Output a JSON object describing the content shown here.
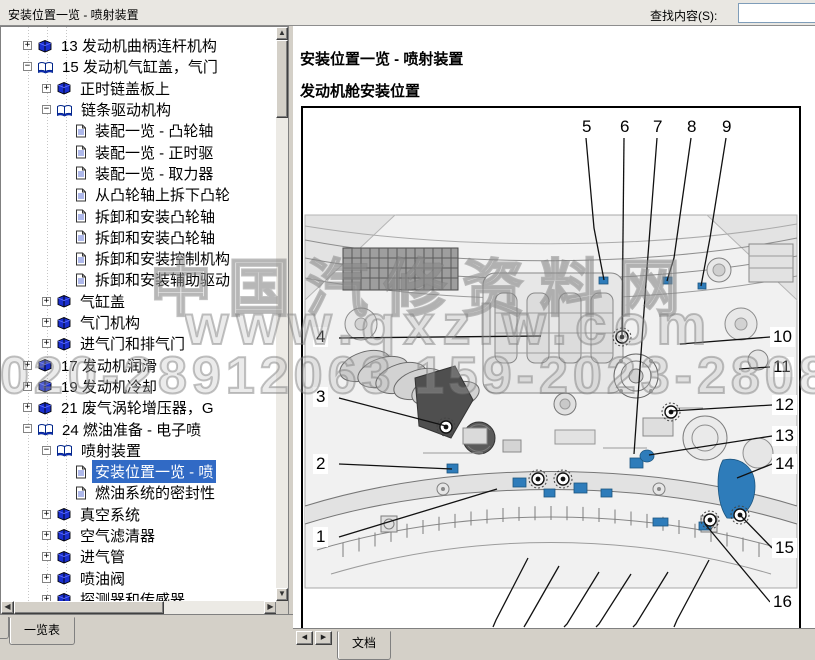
{
  "window": {
    "title": "安装位置一览 - 喷射装置",
    "find_label": "查找内容(S):",
    "find_value": ""
  },
  "sidebar": {
    "tab_label": "一览表",
    "items": [
      {
        "label": "13 发动机曲柄连杆机构",
        "level": 1,
        "icon": "book-closed",
        "expand": "plus"
      },
      {
        "label": "15 发动机气缸盖，气门",
        "level": 1,
        "icon": "book-open",
        "expand": "minus"
      },
      {
        "label": "正时链盖板上",
        "level": 2,
        "icon": "book-closed",
        "expand": "plus"
      },
      {
        "label": "链条驱动机构",
        "level": 2,
        "icon": "book-open",
        "expand": "minus"
      },
      {
        "label": "装配一览 - 凸轮轴",
        "level": 3,
        "icon": "page",
        "expand": "none"
      },
      {
        "label": "装配一览 - 正时驱",
        "level": 3,
        "icon": "page",
        "expand": "none"
      },
      {
        "label": "装配一览 - 取力器",
        "level": 3,
        "icon": "page",
        "expand": "none"
      },
      {
        "label": "从凸轮轴上拆下凸轮",
        "level": 3,
        "icon": "page",
        "expand": "none"
      },
      {
        "label": "拆卸和安装凸轮轴",
        "level": 3,
        "icon": "page",
        "expand": "none"
      },
      {
        "label": "拆卸和安装凸轮轴",
        "level": 3,
        "icon": "page",
        "expand": "none"
      },
      {
        "label": "拆卸和安装控制机构",
        "level": 3,
        "icon": "page",
        "expand": "none"
      },
      {
        "label": "拆卸和安装辅助驱动",
        "level": 3,
        "icon": "page",
        "expand": "none"
      },
      {
        "label": "气缸盖",
        "level": 2,
        "icon": "book-closed",
        "expand": "plus"
      },
      {
        "label": "气门机构",
        "level": 2,
        "icon": "book-closed",
        "expand": "plus"
      },
      {
        "label": "进气门和排气门",
        "level": 2,
        "icon": "book-closed",
        "expand": "plus"
      },
      {
        "label": "17 发动机润滑",
        "level": 1,
        "icon": "book-closed",
        "expand": "plus"
      },
      {
        "label": "19 发动机冷却",
        "level": 1,
        "icon": "book-closed",
        "expand": "plus"
      },
      {
        "label": "21 废气涡轮增压器，G",
        "level": 1,
        "icon": "book-closed",
        "expand": "plus"
      },
      {
        "label": "24 燃油准备 - 电子喷",
        "level": 1,
        "icon": "book-open",
        "expand": "minus"
      },
      {
        "label": "喷射装置",
        "level": 2,
        "icon": "book-open",
        "expand": "minus"
      },
      {
        "label": "安装位置一览 - 喷",
        "level": 3,
        "icon": "page",
        "expand": "none",
        "selected": true
      },
      {
        "label": "燃油系统的密封性",
        "level": 3,
        "icon": "page",
        "expand": "none"
      },
      {
        "label": "真空系统",
        "level": 2,
        "icon": "book-closed",
        "expand": "plus"
      },
      {
        "label": "空气滤清器",
        "level": 2,
        "icon": "book-closed",
        "expand": "plus"
      },
      {
        "label": "进气管",
        "level": 2,
        "icon": "book-closed",
        "expand": "plus"
      },
      {
        "label": "喷油阀",
        "level": 2,
        "icon": "book-closed",
        "expand": "plus"
      },
      {
        "label": "探测器和传感器",
        "level": 2,
        "icon": "book-closed",
        "expand": "plus"
      }
    ]
  },
  "content": {
    "tab_label": "文档",
    "heading1": "安装位置一览 - 喷射装置",
    "heading2": "发动机舱安装位置",
    "figure": {
      "callouts": [
        {
          "n": "1",
          "box": [
            10,
            419
          ],
          "line": "36,429 194,381"
        },
        {
          "n": "2",
          "box": [
            10,
            346
          ],
          "line": "36,356 149,361"
        },
        {
          "n": "3",
          "box": [
            10,
            279
          ],
          "line": "36,290 143,318"
        },
        {
          "n": "4",
          "box": [
            10,
            219
          ],
          "line": "36,230 238,228"
        },
        {
          "n": "5",
          "box": [
            276,
            9
          ],
          "line": "283,30 291,120 301,172"
        },
        {
          "n": "6",
          "box": [
            314,
            9
          ],
          "line": "321,30 319,228"
        },
        {
          "n": "7",
          "box": [
            347,
            9
          ],
          "line": "354,30 344,160 331,346"
        },
        {
          "n": "8",
          "box": [
            381,
            9
          ],
          "line": "388,30 371,150 364,173"
        },
        {
          "n": "9",
          "box": [
            416,
            9
          ],
          "line": "423,30 407,130 398,178"
        },
        {
          "n": "10",
          "box": [
            467,
            219
          ],
          "line": "467,229 377,236"
        },
        {
          "n": "11",
          "box": [
            467,
            249
          ],
          "line": "467,259 436,261"
        },
        {
          "n": "12",
          "box": [
            469,
            287
          ],
          "line": "469,297 368,303"
        },
        {
          "n": "13",
          "box": [
            469,
            318
          ],
          "line": "469,328 346,347"
        },
        {
          "n": "14",
          "box": [
            469,
            346
          ],
          "line": "469,356 434,370"
        },
        {
          "n": "15",
          "box": [
            469,
            430
          ],
          "line": "469,440 437,407"
        },
        {
          "n": "16",
          "box": [
            467,
            484
          ],
          "line": "467,494 402,416"
        }
      ]
    }
  },
  "watermark": {
    "line1": "中国汽修资料网",
    "line2": "www.qxzlw.com",
    "line3": "020-28912063 159-2023-2808"
  }
}
